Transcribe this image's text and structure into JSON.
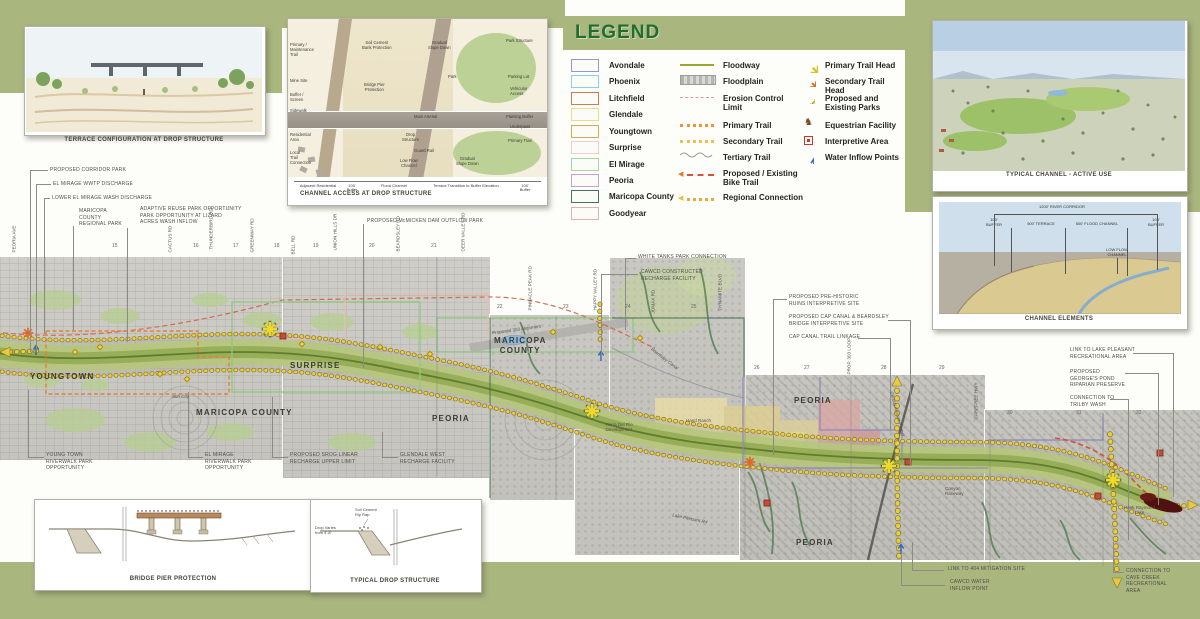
{
  "legend": {
    "title": "LEGEND",
    "municipalities": [
      {
        "label": "Avondale",
        "color": "#9a94cc"
      },
      {
        "label": "Phoenix",
        "color": "#86d2e4"
      },
      {
        "label": "Litchfield",
        "color": "#c97c52"
      },
      {
        "label": "Glendale",
        "color": "#e4de8e"
      },
      {
        "label": "Youngtown",
        "color": "#d8a752"
      },
      {
        "label": "Surprise",
        "color": "#eccfc6"
      },
      {
        "label": "El Mirage",
        "color": "#a8d49e"
      },
      {
        "label": "Peoria",
        "color": "#c7a0ce"
      },
      {
        "label": "Maricopa County",
        "color": "#49705a"
      },
      {
        "label": "Goodyear",
        "color": "#e4b2ac"
      }
    ],
    "lines": [
      {
        "label": "Floodway"
      },
      {
        "label": "Floodplain"
      },
      {
        "label": "Erosion Control\nLimit"
      },
      {
        "label": "Primary Trail"
      },
      {
        "label": "Secondary Trail"
      },
      {
        "label": "Tertiary Trail"
      },
      {
        "label": "Proposed / Existing\nBike Trail"
      },
      {
        "label": "Regional Connection"
      }
    ],
    "symbols": [
      {
        "label": "Primary Trail Head"
      },
      {
        "label": "Secondary Trail Head"
      },
      {
        "label": "Proposed and\nExisting Parks"
      },
      {
        "label": "Equestrian Facility"
      },
      {
        "label": "Interpretive Area"
      },
      {
        "label": "Water Inflow Points"
      }
    ]
  },
  "insets": {
    "terrace": {
      "caption": "TERRACE CONFIGURATION AT DROP STRUCTURE"
    },
    "channel_access": {
      "caption": "CHANNEL ACCESS AT DROP STRUCTURE",
      "left": [
        "Primary /\nMaintenance\nTrail",
        "Mine Site",
        "Buffer /\nScreen",
        "Sidewalk",
        "Residential\nArea",
        "Local\nTrail\nConnection"
      ],
      "right": [
        "Park Structure",
        "Parking Lot",
        "Vehicular\nAccess",
        "Planting Buffer",
        "Underpass",
        "Primary Trail"
      ],
      "center": [
        "Soil Cement\nBank Protection",
        "Gradual\nSlope Down",
        "Park",
        "Bridge Pier\nProtection",
        "Main Arterial",
        "Drop\nStructure",
        "Guard Rail",
        "Low Flow\nChannel",
        "Gradual\nSlope Down"
      ],
      "scale": [
        "Adjacent Residential",
        "100'\nBuffer",
        "Flood Channel",
        "Terrace Transition to Buffer Elevation",
        "100'\nBuffer"
      ]
    },
    "typical_channel": {
      "caption": "TYPICAL CHANNEL - ACTIVE USE"
    },
    "channel_elements": {
      "caption": "CHANNEL ELEMENTS",
      "dims": [
        "1200' RIVER CORRIDOR",
        "100'\nBUFFER",
        "500' TERRACE",
        "500' FLOOD CHANNEL",
        "100'\nBUFFER",
        "LOW FLOW\nCHANNEL"
      ]
    },
    "bridge_pier": {
      "caption": "BRIDGE PIER PROTECTION"
    },
    "typical_drop": {
      "caption": "TYPICAL DROP STRUCTURE",
      "labels": [
        "Soil Cement\nRip Rap",
        "Drop Varies\nfrom 4'-8'"
      ]
    }
  },
  "map": {
    "cities": [
      "YOUNGTOWN",
      "SURPRISE",
      "MARICOPA  COUNTY",
      "MARICOPA\nCOUNTY",
      "PEORIA",
      "PEORIA",
      "PEORIA"
    ],
    "places": {
      "sun_city": "Sun City",
      "prop303": "Proposed 303 Alignment",
      "beardsley": "Beardsley Canal",
      "tierra": "Tierra Del Rio\nDevelopment",
      "hand_ranch": "Hand Ranch",
      "cap_canal": "Central Arizona Project",
      "prop303_loop": "PROP. 303 LOOP",
      "carefree": "CAREFREE HWY",
      "canyon": "Canyon\nRaceway",
      "lake_pleasant_rd": "Lake Pleasant Rd",
      "hank_raymond": "Hank Raymond\nLake"
    },
    "roads": [
      "PEORIA AVE",
      "CACTUS RD",
      "THUNDERBIRD RD",
      "GREENWAY RD",
      "BELL RD",
      "UNION HILLS DR",
      "BEARDSLEY RD",
      "DEER VALLEY RD",
      "PINNACLE PEAK RD",
      "HAPPY VALLEY RD",
      "JOMAX RD",
      "DYNAMITE BLVD"
    ],
    "sections": [
      "15",
      "16",
      "17",
      "18",
      "19",
      "20",
      "21",
      "22",
      "23",
      "24",
      "25",
      "26",
      "27",
      "28",
      "29",
      "30",
      "31",
      "32"
    ],
    "callouts": [
      "PROPOSED CORRIDOR PARK",
      "EL MIRAGE WWTP DISCHARGE",
      "LOWER EL MIRAGE WASH DISCHARGE",
      "MARICOPA\nCOUNTY\nREGIONAL PARK",
      "ADAPTIVE REUSE PARK OPPORTUNITY\nPARK OPPORTUNITY AT LIZARD\nACRES WASH INFLOW",
      "PROPOSED McMICKEN DAM OUTFLOW PARK",
      "WHITE TANKS PARK CONNECTION",
      "CAWCD CONSTRUCTED\nRECHARGE FACILITY",
      "PROPOSED PRE-HISTORIC\nRUINS INTERPRETIVE SITE",
      "PROPOSED CAP CANAL & BEARDSLEY\nBRIDGE INTERPRETIVE SITE",
      "CAP CANAL TRAIL LINKAGE",
      "LINK TO LAKE PLEASANT\nRECREATIONAL AREA",
      "PROPOSED\nGEORGE'S POND\nRIPARIAN PRESERVE",
      "CONNECTION TO\nTRILBY WASH",
      "YOUNG TOWN\nRIVERWALK PARK\nOPPORTUNITY",
      "EL MIRAGE\nRIVERWALK PARK\nOPPORTUNITY",
      "PROPOSED SROG LINEAR\nRECHARGE UPPER LIMIT",
      "GLENDALE WEST\nRECHARGE FACILITY",
      "LINK TO 404 MITIGATION SITE",
      "CAWCD WATER\nINFLOW POINT",
      "CONNECTION TO\nCAVE CREEK\nRECREATIONAL\nAREA"
    ]
  },
  "colors": {
    "band_green": "#a9b67e",
    "legend_title_green": "#1f6e2d",
    "floodway_olive": "#9aa82e",
    "trail_yellow": "#e9cd44",
    "primary_trail_orange": "#e8953f",
    "secondary_trail_yellow": "#eac04e",
    "bike_trail_red": "#d85038",
    "erosion_pink": "#e29a92",
    "interpretive_red": "#c43a28",
    "water_inflow_blue": "#2f62c8"
  }
}
